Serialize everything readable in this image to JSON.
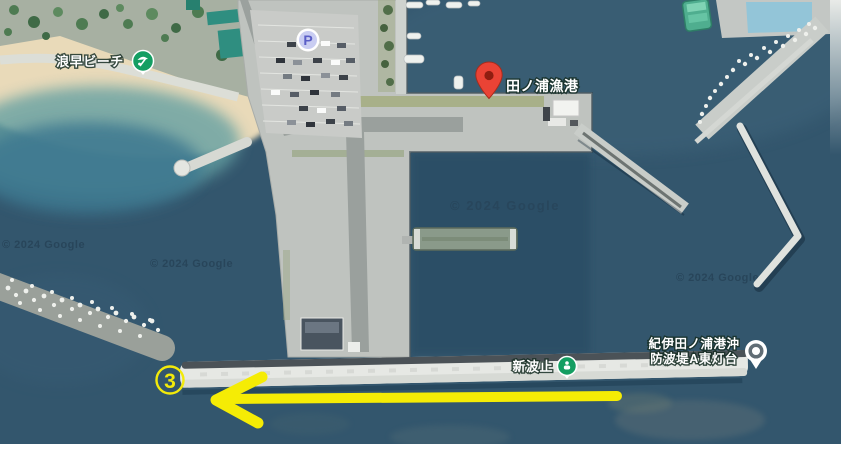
{
  "map": {
    "provider": "Google satellite imagery",
    "attribution": "© 2024 Google",
    "parking_icon_letter": "P",
    "pois": {
      "beach": {
        "label": "浪早ビーチ",
        "icon": "beach-poi-icon",
        "icon_color": "#149e62"
      },
      "port": {
        "label": "田ノ浦漁港",
        "icon": "red-pin-icon",
        "icon_color": "#ea4335"
      },
      "breakwater": {
        "label": "新波止",
        "icon": "green-poi-icon",
        "icon_color": "#149e62"
      },
      "lighthouse": {
        "line1": "紀伊田ノ浦港沖",
        "line2": "防波堤A東灯台",
        "icon": "lighthouse-icon",
        "icon_color": "#616d75"
      }
    }
  },
  "annotations": {
    "step_number": "3",
    "arrow_direction": "left",
    "accent_color": "#f5ec05"
  },
  "colors": {
    "sea": "#33566d",
    "sand": "#e9dab9",
    "concrete": "#bfc3bf",
    "breakwater_white": "#e8eae6",
    "poi_green": "#149e62",
    "pin_red": "#ea4335",
    "annotation_yellow": "#f2ea0a"
  }
}
